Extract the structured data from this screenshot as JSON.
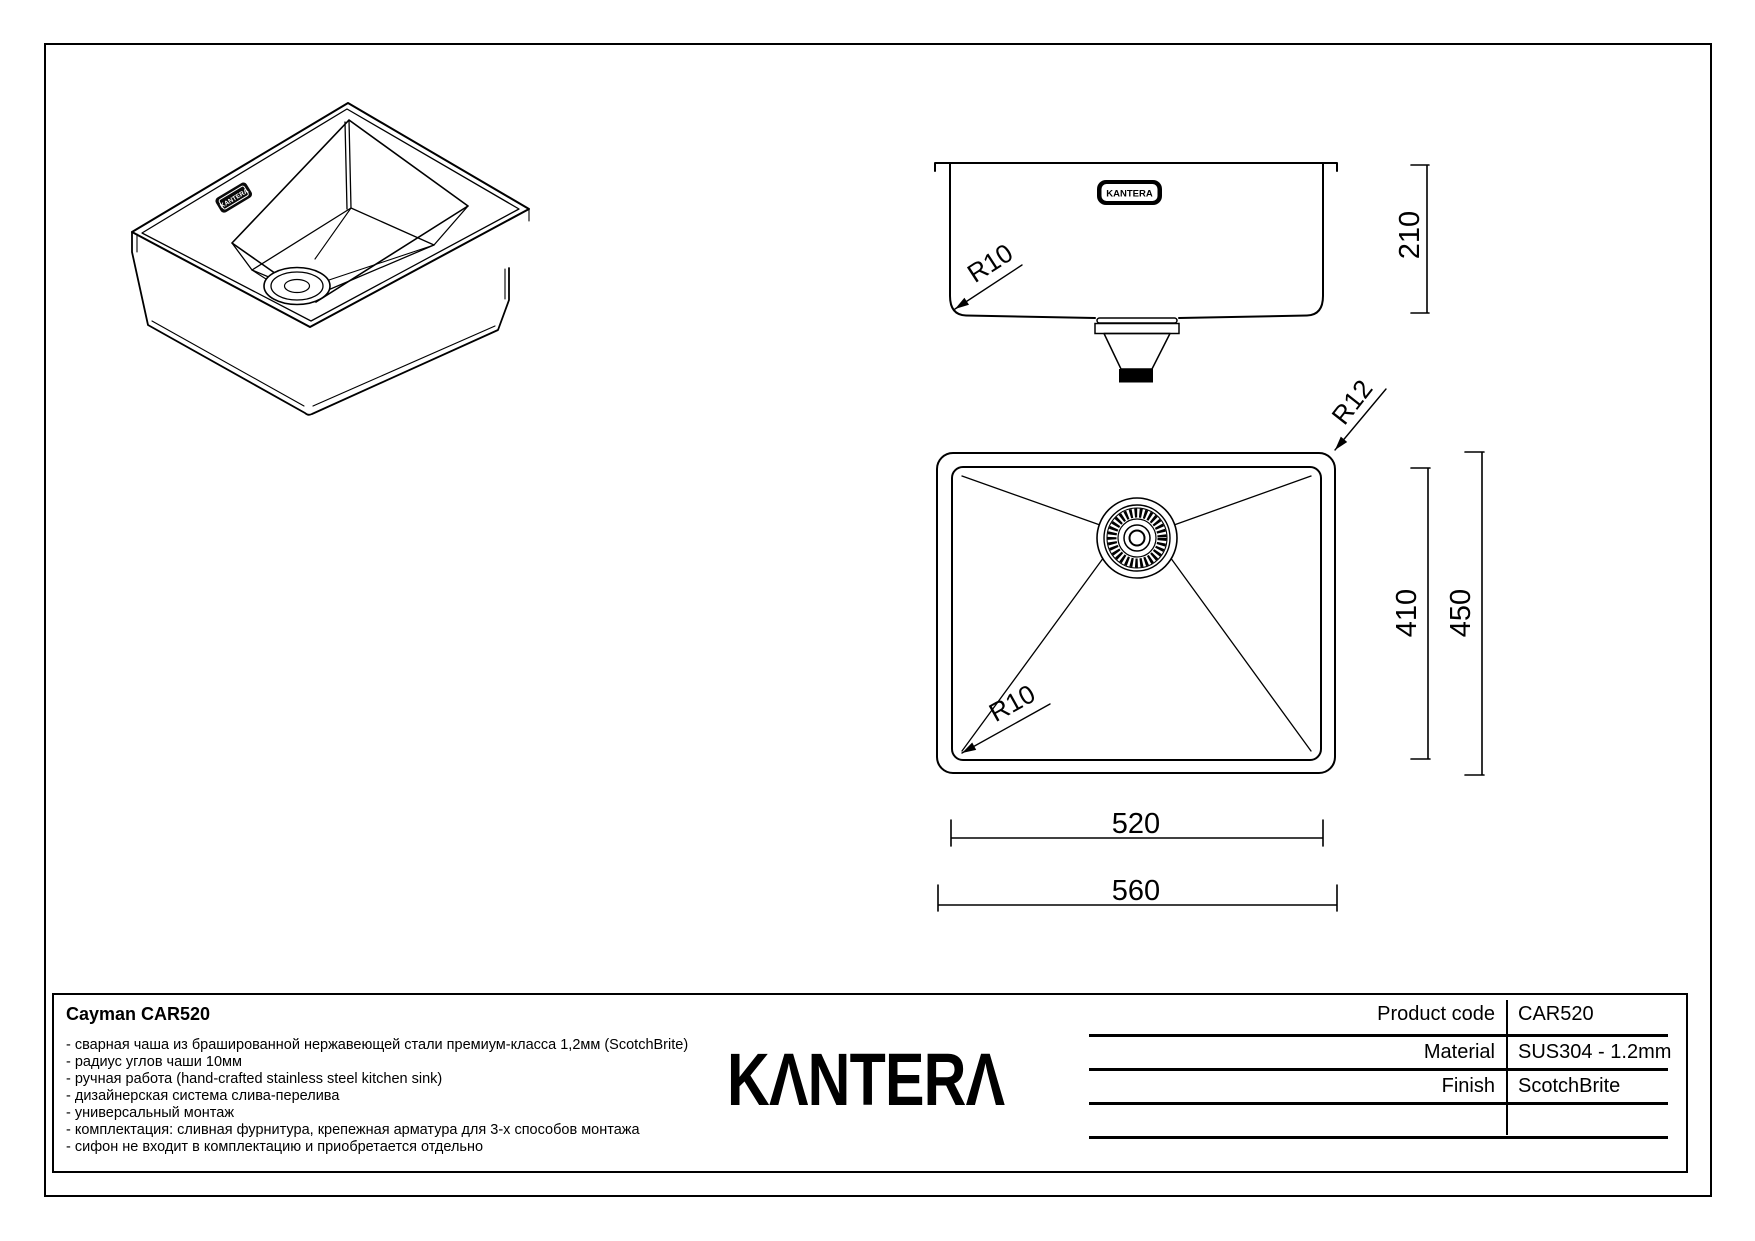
{
  "sheet": {
    "product_title": "Cayman CAR520",
    "brand": "KANTERA",
    "logo_display": "KΛNTERΛ",
    "features": [
      "- сварная чаша из брашированной нержавеющей стали премиум-класса 1,2мм (ScotchBrite)",
      "- радиус углов чаши 10мм",
      "- ручная работа (hand-crafted stainless steel kitchen sink)",
      "- дизайнерская система слива-перелива",
      "- универсальный монтаж",
      "- комплектация: сливная фурнитура, крепежная арматура для 3-х способов монтажа",
      "- сифон не входит в комплектацию и приобретается отдельно"
    ],
    "spec_table": {
      "rows": [
        {
          "label": "Product code",
          "value": "CAR520"
        },
        {
          "label": "Material",
          "value": "SUS304 - 1.2mm"
        },
        {
          "label": "Finish",
          "value": "ScotchBrite"
        }
      ]
    },
    "dimensions": {
      "depth": "210",
      "bowl_width": "520",
      "overall_width": "560",
      "bowl_length": "410",
      "overall_length": "450"
    },
    "radius_labels": {
      "bowl": "R10",
      "rim": "R12"
    },
    "colors": {
      "ink": "#000000",
      "paper": "#ffffff"
    }
  }
}
